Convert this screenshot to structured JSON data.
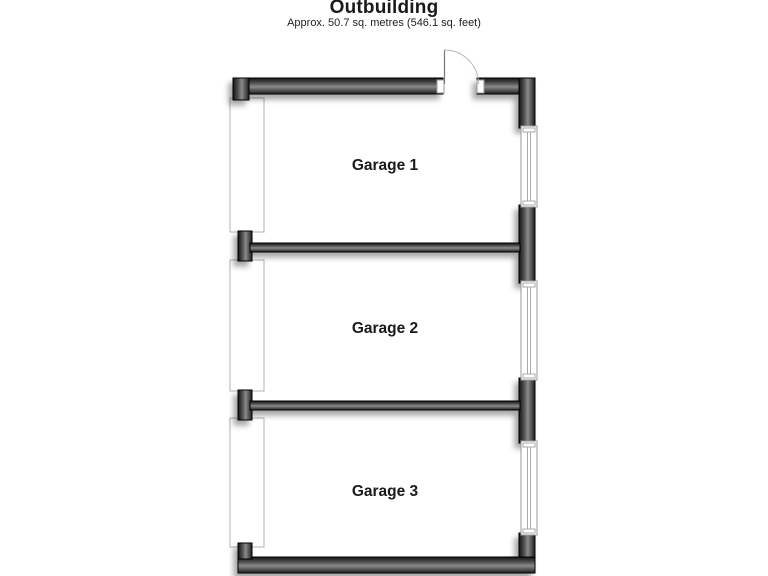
{
  "title": "Outbuilding",
  "subtitle": "Approx. 50.7 sq. metres (546.1 sq. feet)",
  "rooms": [
    {
      "label": "Garage 1"
    },
    {
      "label": "Garage 2"
    },
    {
      "label": "Garage 3"
    }
  ],
  "colors": {
    "background": "#ffffff",
    "wall_dark": "#141414",
    "wall_mid": "#848484",
    "fixture_outline": "#9a9a9a",
    "label_text": "#1a1a1a"
  }
}
